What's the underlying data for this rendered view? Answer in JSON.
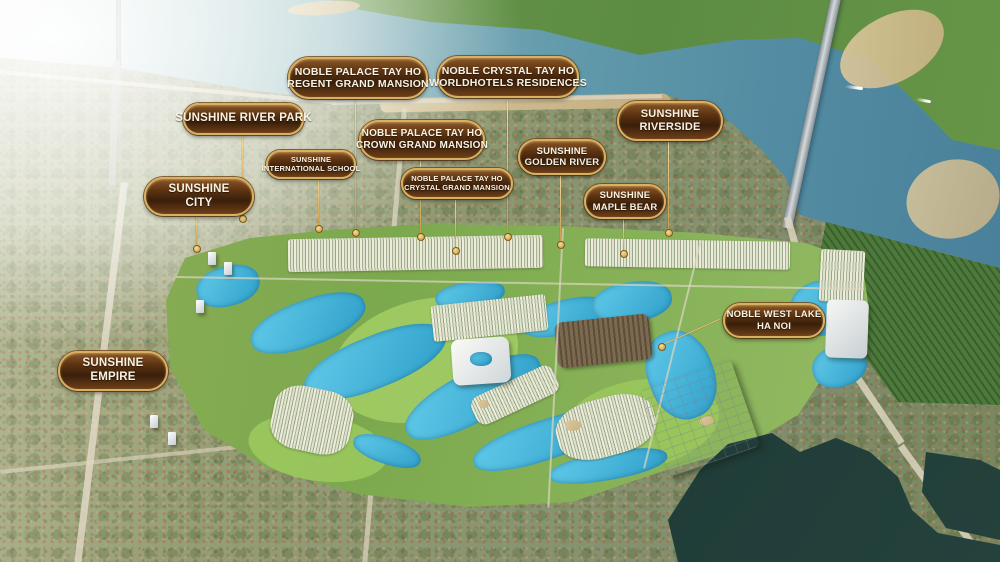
{
  "meta": {
    "description": "Aerial masterplan map of Sunshine Group projects along the Red River and West Lake, Ha Noi"
  },
  "colors": {
    "badge_border": "#d8b061",
    "badge_bg_dark": "#3a1f0a",
    "badge_bg_light": "#8a5526",
    "badge_text": "#f8f2e4",
    "leader_line": "#d9b25f",
    "river_water": "#6099aa",
    "sun_glare": "#ffffff",
    "farmland_green": "#5c8c42",
    "masterplan_green": "#8ab45b",
    "lagoon_blue": "#3fb3dc",
    "west_lake_water": "#1d3a36",
    "sand": "#d6c394"
  },
  "badges": [
    {
      "id": "noble-palace-regent",
      "line1": "NOBLE PALACE TAY HO",
      "line2": "REGENT GRAND MANSION"
    },
    {
      "id": "noble-crystal-worldhotels",
      "line1": "NOBLE CRYSTAL TAY HO",
      "line2": "WORLDHOTELS RESIDENCES"
    },
    {
      "id": "sunshine-river-park",
      "line1": "SUNSHINE RIVER PARK"
    },
    {
      "id": "sunshine-riverside",
      "line1": "SUNSHINE",
      "line2": "RIVERSIDE"
    },
    {
      "id": "noble-palace-crown",
      "line1": "NOBLE PALACE TAY HO",
      "line2": "CROWN GRAND MANSION"
    },
    {
      "id": "sunshine-golden-river",
      "line1": "SUNSHINE",
      "line2": "GOLDEN RIVER"
    },
    {
      "id": "sunshine-international-school",
      "line1": "SUNSHINE",
      "line2": "INTERNATIONAL SCHOOL"
    },
    {
      "id": "sunshine-city",
      "line1": "SUNSHINE",
      "line2": "CITY"
    },
    {
      "id": "noble-palace-crystal",
      "line1": "NOBLE PALACE TAY HO",
      "line2": "CRYSTAL GRAND MANSION"
    },
    {
      "id": "sunshine-maple-bear",
      "line1": "SUNSHINE",
      "line2": "MAPLE BEAR"
    },
    {
      "id": "noble-west-lake",
      "line1": "NOBLE WEST LAKE",
      "line2": "HA NOI"
    },
    {
      "id": "sunshine-empire",
      "line1": "SUNSHINE",
      "line2": "EMPIRE"
    }
  ],
  "map_features": [
    "red-river",
    "thang-long-bridge",
    "nhat-tan-bridge",
    "west-lake",
    "north-bank-farmland",
    "sand-bars",
    "masterplan-render",
    "golf-lagoons",
    "urban-area",
    "lotte-mall-building",
    "boats"
  ]
}
